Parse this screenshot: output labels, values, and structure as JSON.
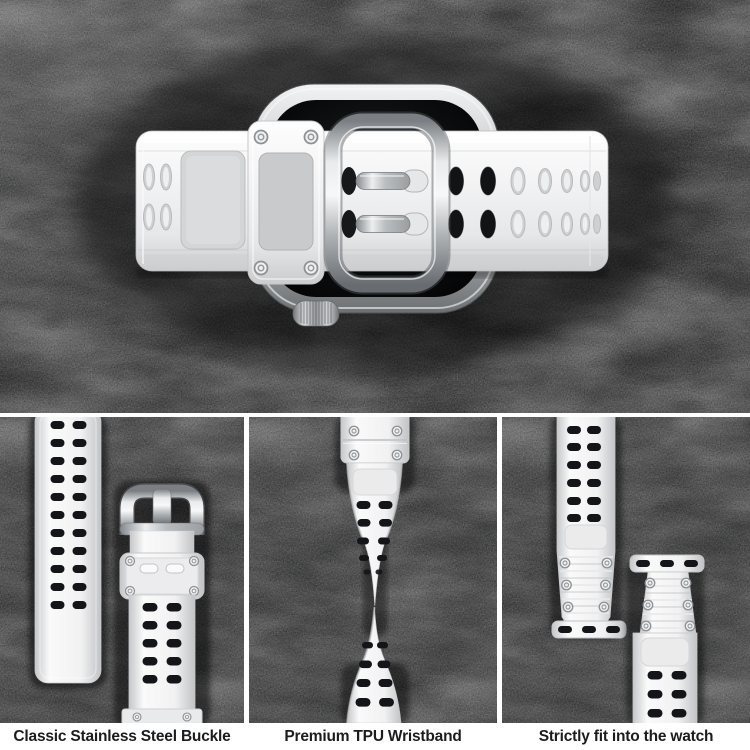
{
  "hero": {
    "subject": "smartwatch-top-view-with-white-band-and-steel-buckle"
  },
  "panels": [
    {
      "id": "buckle",
      "caption": "Classic Stainless Steel Buckle"
    },
    {
      "id": "wristband",
      "caption": "Premium TPU Wristband"
    },
    {
      "id": "fit",
      "caption": "Strictly fit into the watch"
    }
  ],
  "colors": {
    "background_texture": "#17181a",
    "divider": "#ffffff",
    "caption_bar": "#ffffff",
    "caption_text": "#1b1c1d",
    "band_white": "#f4f4f5",
    "steel_silver": "#c3c6c9",
    "screen_black": "#0a0b0c",
    "hole_black": "#141518"
  }
}
